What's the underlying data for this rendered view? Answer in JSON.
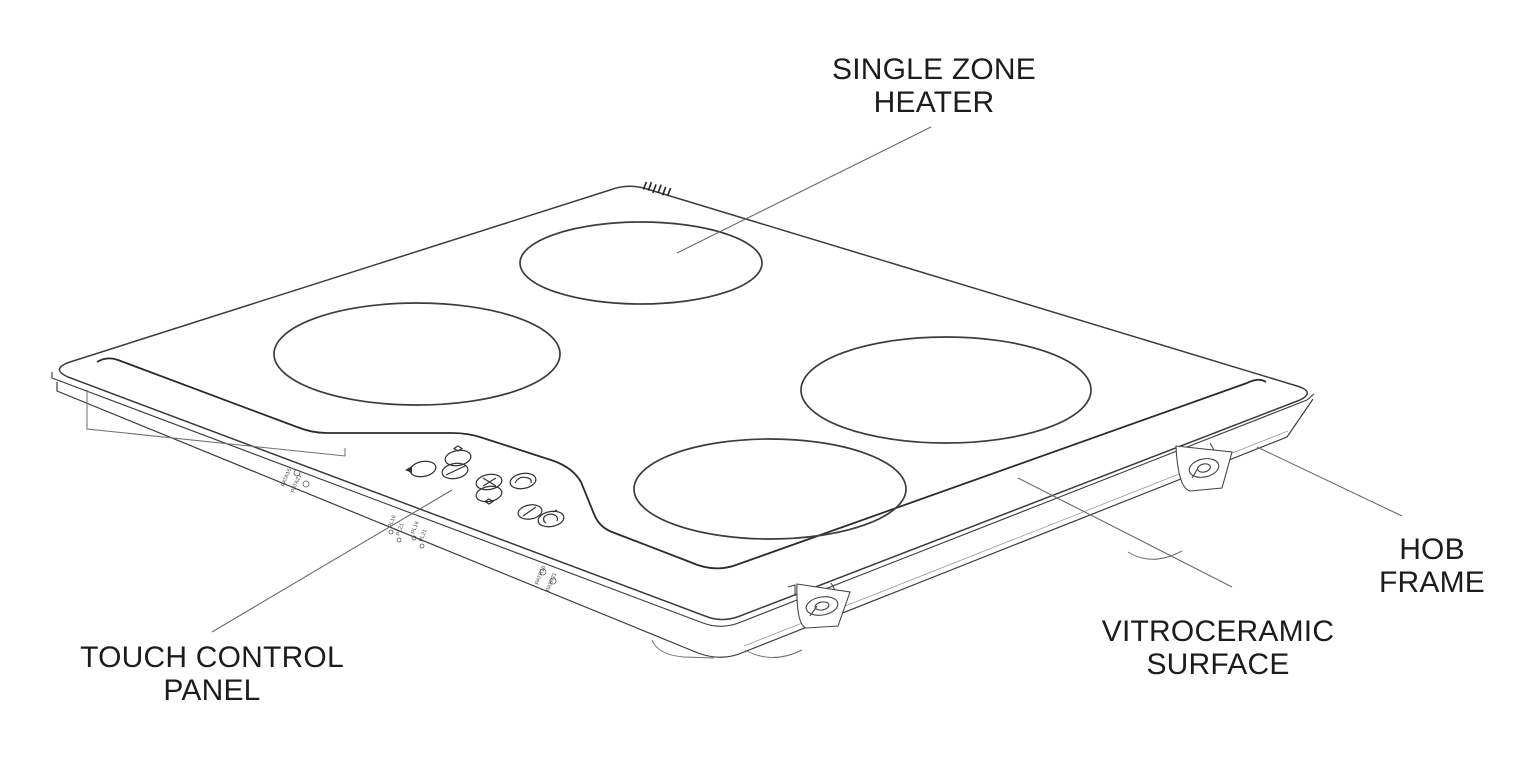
{
  "page": {
    "background": "#ffffff"
  },
  "diagram": {
    "type": "technical-illustration",
    "subject": "vitroceramic hob, perspective exploded-style view with part callouts",
    "colors": {
      "outline": "#3c3c3c",
      "decor_line": "#2b2b2b",
      "label_text": "#1c1c1c",
      "leader_line": "#6b6b6b"
    },
    "labels": {
      "single_zone_heater": [
        "SINGLE ZONE",
        "HEATER"
      ],
      "touch_control_panel": [
        "TOUCH CONTROL",
        "PANEL"
      ],
      "hob_frame": [
        "HOB",
        "FRAME"
      ],
      "vitroceramic_surface": [
        "VITROCERAMIC",
        "SURFACE"
      ]
    },
    "frame_markings": [
      "PATA16",
      "PATA21",
      "PL16",
      "PL21",
      "PL16",
      "PL21",
      "PATR16",
      "PATR21"
    ]
  }
}
